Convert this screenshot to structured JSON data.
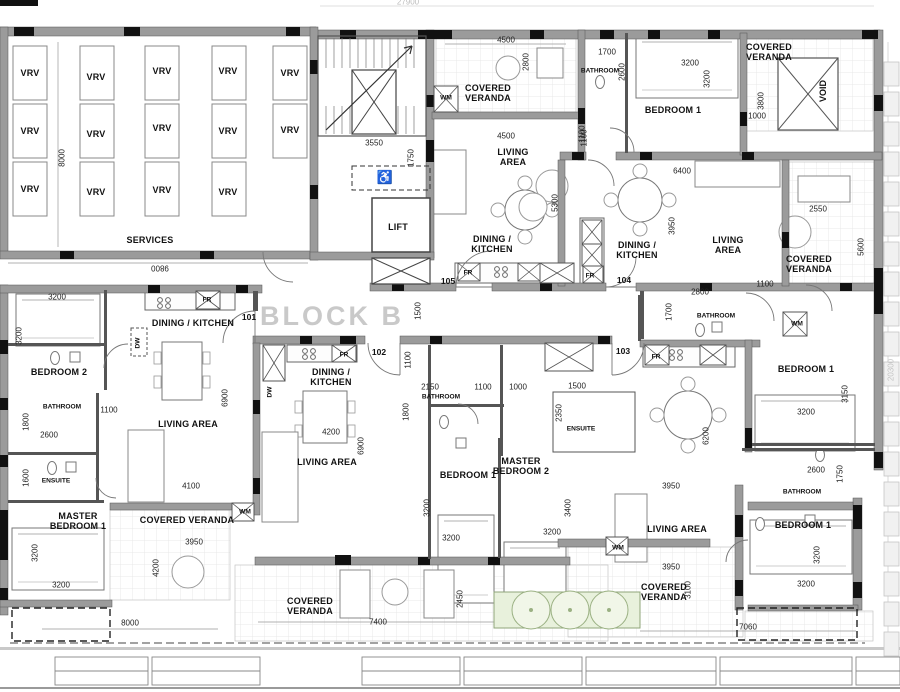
{
  "drawing": {
    "block_title": "BLOCK B",
    "overall_dims": {
      "top": "27900",
      "right": "20300"
    }
  },
  "annotations": [
    {
      "n": "vrv-label",
      "t": "VRV",
      "x": 30,
      "y": 73,
      "c": "room"
    },
    {
      "n": "vrv-label",
      "t": "VRV",
      "x": 30,
      "y": 131,
      "c": "room"
    },
    {
      "n": "vrv-label",
      "t": "VRV",
      "x": 30,
      "y": 189,
      "c": "room"
    },
    {
      "n": "vrv-label",
      "t": "VRV",
      "x": 96,
      "y": 77,
      "c": "room"
    },
    {
      "n": "vrv-label",
      "t": "VRV",
      "x": 96,
      "y": 134,
      "c": "room"
    },
    {
      "n": "vrv-label",
      "t": "VRV",
      "x": 96,
      "y": 192,
      "c": "room"
    },
    {
      "n": "vrv-label",
      "t": "VRV",
      "x": 162,
      "y": 71,
      "c": "room"
    },
    {
      "n": "vrv-label",
      "t": "VRV",
      "x": 162,
      "y": 128,
      "c": "room"
    },
    {
      "n": "vrv-label",
      "t": "VRV",
      "x": 162,
      "y": 190,
      "c": "room"
    },
    {
      "n": "vrv-label",
      "t": "VRV",
      "x": 228,
      "y": 71,
      "c": "room"
    },
    {
      "n": "vrv-label",
      "t": "VRV",
      "x": 228,
      "y": 131,
      "c": "room"
    },
    {
      "n": "vrv-label",
      "t": "VRV",
      "x": 228,
      "y": 192,
      "c": "room"
    },
    {
      "n": "vrv-label",
      "t": "VRV",
      "x": 290,
      "y": 73,
      "c": "room"
    },
    {
      "n": "vrv-label",
      "t": "VRV",
      "x": 290,
      "y": 130,
      "c": "room"
    },
    {
      "n": "room-label-services",
      "t": "SERVICES",
      "x": 150,
      "y": 240,
      "c": "room"
    },
    {
      "n": "dim-services-width",
      "t": "9800",
      "x": 160,
      "y": 267,
      "c": "dim180"
    },
    {
      "n": "dim-services-height",
      "t": "8000",
      "x": 63,
      "y": 158,
      "c": "dimv"
    },
    {
      "n": "dim-overall-top",
      "t": "27900",
      "x": 408,
      "y": 3,
      "c": "gray"
    },
    {
      "n": "dim-overall-right",
      "t": "20300",
      "x": 892,
      "y": 370,
      "c": "grayv"
    },
    {
      "n": "dim-stair-width",
      "t": "3550",
      "x": 374,
      "y": 144,
      "c": "dim"
    },
    {
      "n": "dim-stair-depth",
      "t": "1750",
      "x": 412,
      "y": 158,
      "c": "dimv"
    },
    {
      "n": "room-label-lift",
      "t": "LIFT",
      "x": 398,
      "y": 227,
      "c": "room"
    },
    {
      "n": "wheelchair-symbol",
      "t": "♿",
      "x": 385,
      "y": 178,
      "c": "sym"
    },
    {
      "n": "unit-number-105",
      "t": "105",
      "x": 448,
      "y": 282,
      "c": "num"
    },
    {
      "n": "wm-label-105",
      "t": "WM",
      "x": 446,
      "y": 98,
      "c": "rsmall"
    },
    {
      "n": "room-label-veranda-105",
      "t": "COVERED\nVERANDA",
      "x": 488,
      "y": 93,
      "c": "room"
    },
    {
      "n": "dim-veranda-105",
      "t": "4500",
      "x": 506,
      "y": 41,
      "c": "dim"
    },
    {
      "n": "dim-veranda-105-depth",
      "t": "2800",
      "x": 527,
      "y": 62,
      "c": "dimv"
    },
    {
      "n": "dim-living-105",
      "t": "4500",
      "x": 506,
      "y": 137,
      "c": "dim"
    },
    {
      "n": "dim-105-1100",
      "t": "1100",
      "x": 583,
      "y": 134,
      "c": "dimv"
    },
    {
      "n": "room-label-living-105",
      "t": "LIVING\nAREA",
      "x": 513,
      "y": 157,
      "c": "room"
    },
    {
      "n": "dim-living-105-depth",
      "t": "5300",
      "x": 556,
      "y": 203,
      "c": "dimv"
    },
    {
      "n": "room-label-dining-105",
      "t": "DINING /\nKITCHEN",
      "x": 492,
      "y": 244,
      "c": "room"
    },
    {
      "n": "fr-label-105",
      "t": "FR",
      "x": 468,
      "y": 273,
      "c": "rsmall"
    },
    {
      "n": "dim-corridor",
      "t": "1500",
      "x": 419,
      "y": 311,
      "c": "dimv"
    },
    {
      "n": "dim-corridor-entry",
      "t": "1100",
      "x": 409,
      "y": 360,
      "c": "dimv"
    },
    {
      "n": "block-title",
      "t": "BLOCK B",
      "x": 332,
      "y": 316,
      "c": "big"
    },
    {
      "n": "unit-number-101",
      "t": "101",
      "x": 249,
      "y": 318,
      "c": "num"
    },
    {
      "n": "room-label-dining-101",
      "t": "DINING / KITCHEN",
      "x": 193,
      "y": 323,
      "c": "room"
    },
    {
      "n": "fr-label-101",
      "t": "FR",
      "x": 207,
      "y": 300,
      "c": "rsmall"
    },
    {
      "n": "dw-label-101",
      "t": "DW",
      "x": 138,
      "y": 343,
      "c": "rsmallv"
    },
    {
      "n": "dim-bedroom2-width",
      "t": "3200",
      "x": 57,
      "y": 298,
      "c": "dim"
    },
    {
      "n": "dim-bedroom2-height",
      "t": "3200",
      "x": 20,
      "y": 336,
      "c": "dimv"
    },
    {
      "n": "room-label-bedroom2-101",
      "t": "BEDROOM 2",
      "x": 59,
      "y": 372,
      "c": "room"
    },
    {
      "n": "room-label-bath-101",
      "t": "BATHROOM",
      "x": 62,
      "y": 407,
      "c": "rsmall"
    },
    {
      "n": "dim-bath-101",
      "t": "1800",
      "x": 27,
      "y": 422,
      "c": "dimv"
    },
    {
      "n": "dim-bath-101-w",
      "t": "2600",
      "x": 49,
      "y": 436,
      "c": "dim"
    },
    {
      "n": "dim-101-1100",
      "t": "1100",
      "x": 109,
      "y": 411,
      "c": "dim"
    },
    {
      "n": "room-label-living-101",
      "t": "LIVING AREA",
      "x": 188,
      "y": 424,
      "c": "room"
    },
    {
      "n": "dim-living-101-depth",
      "t": "6900",
      "x": 226,
      "y": 398,
      "c": "dimv"
    },
    {
      "n": "room-label-ensuite-101",
      "t": "ENSUITE",
      "x": 56,
      "y": 481,
      "c": "rsmall"
    },
    {
      "n": "dim-ensuite-101",
      "t": "1600",
      "x": 27,
      "y": 478,
      "c": "dimv"
    },
    {
      "n": "room-label-master1-101",
      "t": "MASTER\nBEDROOM 1",
      "x": 78,
      "y": 521,
      "c": "room"
    },
    {
      "n": "dim-master1-101-h",
      "t": "3200",
      "x": 36,
      "y": 553,
      "c": "dimv"
    },
    {
      "n": "dim-master1-101-w",
      "t": "3200",
      "x": 61,
      "y": 586,
      "c": "dim"
    },
    {
      "n": "dim-living-101-w",
      "t": "4100",
      "x": 191,
      "y": 487,
      "c": "dim"
    },
    {
      "n": "room-label-veranda-101",
      "t": "COVERED VERANDA",
      "x": 187,
      "y": 520,
      "c": "room"
    },
    {
      "n": "wm-label-101",
      "t": "WM",
      "x": 245,
      "y": 512,
      "c": "rsmall"
    },
    {
      "n": "dim-veranda-101",
      "t": "3950",
      "x": 194,
      "y": 543,
      "c": "dim"
    },
    {
      "n": "dim-veranda-101-h",
      "t": "4200",
      "x": 157,
      "y": 568,
      "c": "dimv"
    },
    {
      "n": "dim-bottom-left",
      "t": "8000",
      "x": 130,
      "y": 624,
      "c": "dim"
    },
    {
      "n": "unit-number-102",
      "t": "102",
      "x": 379,
      "y": 353,
      "c": "num"
    },
    {
      "n": "room-label-dining-102",
      "t": "DINING /\nKITCHEN",
      "x": 331,
      "y": 377,
      "c": "room"
    },
    {
      "n": "fr-label-102",
      "t": "FR",
      "x": 344,
      "y": 355,
      "c": "rsmall"
    },
    {
      "n": "dw-label-102",
      "t": "DW",
      "x": 270,
      "y": 392,
      "c": "rsmallv"
    },
    {
      "n": "dim-dining-102",
      "t": "4200",
      "x": 331,
      "y": 433,
      "c": "dim"
    },
    {
      "n": "room-label-living-102",
      "t": "LIVING AREA",
      "x": 327,
      "y": 462,
      "c": "room"
    },
    {
      "n": "dim-living-102-depth",
      "t": "6900",
      "x": 362,
      "y": 446,
      "c": "dimv"
    },
    {
      "n": "dim-bath-102-w",
      "t": "2150",
      "x": 430,
      "y": 388,
      "c": "dim"
    },
    {
      "n": "dim-102-1100",
      "t": "1100",
      "x": 483,
      "y": 388,
      "c": "dim"
    },
    {
      "n": "dim-102-1000",
      "t": "1000",
      "x": 518,
      "y": 388,
      "c": "dim"
    },
    {
      "n": "dim-102-1500",
      "t": "1500",
      "x": 577,
      "y": 387,
      "c": "dim"
    },
    {
      "n": "room-label-bath-102",
      "t": "BATHROOM",
      "x": 441,
      "y": 397,
      "c": "rsmall"
    },
    {
      "n": "dim-bath-102-h",
      "t": "1800",
      "x": 407,
      "y": 412,
      "c": "dimv"
    },
    {
      "n": "room-label-bedroom1-102",
      "t": "BEDROOM 1",
      "x": 468,
      "y": 475,
      "c": "room"
    },
    {
      "n": "dim-bedroom1-102-h",
      "t": "3200",
      "x": 428,
      "y": 508,
      "c": "dimv"
    },
    {
      "n": "dim-bedroom1-102-w",
      "t": "3200",
      "x": 451,
      "y": 539,
      "c": "dim"
    },
    {
      "n": "room-label-master2-102",
      "t": "MASTER\nBEDROOM 2",
      "x": 521,
      "y": 466,
      "c": "room"
    },
    {
      "n": "dim-master2-102",
      "t": "2350",
      "x": 560,
      "y": 413,
      "c": "dimv"
    },
    {
      "n": "room-label-ensuite-102",
      "t": "ENSUITE",
      "x": 581,
      "y": 429,
      "c": "rsmall"
    },
    {
      "n": "dim-master2-102-h",
      "t": "3400",
      "x": 569,
      "y": 508,
      "c": "dimv"
    },
    {
      "n": "dim-master2-102-w",
      "t": "3200",
      "x": 552,
      "y": 533,
      "c": "dim"
    },
    {
      "n": "room-label-veranda-bottom",
      "t": "COVERED\nVERANDA",
      "x": 310,
      "y": 606,
      "c": "room"
    },
    {
      "n": "dim-veranda-bottom",
      "t": "7400",
      "x": 378,
      "y": 623,
      "c": "dim"
    },
    {
      "n": "dim-veranda-bottom-h",
      "t": "2450",
      "x": 461,
      "y": 599,
      "c": "dimv"
    },
    {
      "n": "unit-number-103",
      "t": "103",
      "x": 623,
      "y": 352,
      "c": "num"
    },
    {
      "n": "fr-label-103",
      "t": "FR",
      "x": 656,
      "y": 357,
      "c": "rsmall"
    },
    {
      "n": "room-label-bath-103",
      "t": "BATHROOM",
      "x": 716,
      "y": 316,
      "c": "rsmall"
    },
    {
      "n": "dim-bath-103-w",
      "t": "2800",
      "x": 700,
      "y": 293,
      "c": "dim"
    },
    {
      "n": "dim-bath-103-h",
      "t": "1700",
      "x": 670,
      "y": 312,
      "c": "dimv"
    },
    {
      "n": "dim-103-1100",
      "t": "1100",
      "x": 765,
      "y": 285,
      "c": "dim"
    },
    {
      "n": "wm-label-103-top",
      "t": "WM",
      "x": 797,
      "y": 324,
      "c": "rsmall"
    },
    {
      "n": "room-label-bedroom1-103",
      "t": "BEDROOM 1",
      "x": 806,
      "y": 369,
      "c": "room"
    },
    {
      "n": "dim-bedroom1-103-h",
      "t": "3150",
      "x": 846,
      "y": 394,
      "c": "dimv"
    },
    {
      "n": "dim-bedroom1-103-w",
      "t": "3200",
      "x": 806,
      "y": 413,
      "c": "dim"
    },
    {
      "n": "dim-living-103-depth",
      "t": "6200",
      "x": 707,
      "y": 436,
      "c": "dimv"
    },
    {
      "n": "dim-living-103-w",
      "t": "3950",
      "x": 671,
      "y": 487,
      "c": "dim"
    },
    {
      "n": "room-label-living-103",
      "t": "LIVING AREA",
      "x": 677,
      "y": 529,
      "c": "room"
    },
    {
      "n": "wm-label-103-btm",
      "t": "WM",
      "x": 618,
      "y": 548,
      "c": "rsmall"
    },
    {
      "n": "room-label-veranda-103",
      "t": "COVERED\nVERANDA",
      "x": 664,
      "y": 592,
      "c": "room"
    },
    {
      "n": "dim-veranda-103",
      "t": "3950",
      "x": 671,
      "y": 568,
      "c": "dim"
    },
    {
      "n": "dim-veranda-103-h",
      "t": "3100",
      "x": 689,
      "y": 590,
      "c": "dimv"
    },
    {
      "n": "room-label-bath2-103",
      "t": "BATHROOM",
      "x": 802,
      "y": 492,
      "c": "rsmall"
    },
    {
      "n": "dim-bath2-103-w",
      "t": "2600",
      "x": 816,
      "y": 471,
      "c": "dim"
    },
    {
      "n": "dim-bath2-103-h",
      "t": "1750",
      "x": 841,
      "y": 474,
      "c": "dimv"
    },
    {
      "n": "room-label-bedroom1b-103",
      "t": "BEDROOM 1",
      "x": 803,
      "y": 525,
      "c": "room"
    },
    {
      "n": "dim-bedroom1b-103-h",
      "t": "3200",
      "x": 818,
      "y": 555,
      "c": "dimv"
    },
    {
      "n": "dim-bedroom1b-103-w",
      "t": "3200",
      "x": 806,
      "y": 585,
      "c": "dim"
    },
    {
      "n": "dim-bottom-right",
      "t": "7060",
      "x": 748,
      "y": 628,
      "c": "dim"
    },
    {
      "n": "unit-number-104",
      "t": "104",
      "x": 624,
      "y": 281,
      "c": "num"
    },
    {
      "n": "room-label-bath-104",
      "t": "BATHROOM",
      "x": 600,
      "y": 71,
      "c": "rsmall"
    },
    {
      "n": "dim-bath-104-w",
      "t": "1700",
      "x": 607,
      "y": 53,
      "c": "dim"
    },
    {
      "n": "dim-bath-104-h",
      "t": "2600",
      "x": 623,
      "y": 72,
      "c": "dimv"
    },
    {
      "n": "room-label-bedroom1-104",
      "t": "BEDROOM 1",
      "x": 673,
      "y": 110,
      "c": "room"
    },
    {
      "n": "dim-bedroom1-104-w",
      "t": "3200",
      "x": 690,
      "y": 64,
      "c": "dim"
    },
    {
      "n": "dim-bedroom1-104-h",
      "t": "3200",
      "x": 708,
      "y": 79,
      "c": "dimv"
    },
    {
      "n": "room-label-veranda-104",
      "t": "COVERED\nVERANDA",
      "x": 769,
      "y": 52,
      "c": "room"
    },
    {
      "n": "dim-veranda-104-h",
      "t": "3800",
      "x": 762,
      "y": 101,
      "c": "dimv"
    },
    {
      "n": "dim-104-1000",
      "t": "1000",
      "x": 757,
      "y": 117,
      "c": "dim"
    },
    {
      "n": "room-label-void",
      "t": "VOID",
      "x": 823,
      "y": 91,
      "c": "roomv"
    },
    {
      "n": "dim-104-1100",
      "t": "1100",
      "x": 585,
      "y": 138,
      "c": "dimv"
    },
    {
      "n": "dim-104-6400",
      "t": "6400",
      "x": 682,
      "y": 172,
      "c": "dim"
    },
    {
      "n": "dim-104-3950",
      "t": "3950",
      "x": 673,
      "y": 226,
      "c": "dimv"
    },
    {
      "n": "room-label-dining-104",
      "t": "DINING /\nKITCHEN",
      "x": 637,
      "y": 250,
      "c": "room"
    },
    {
      "n": "room-label-living-104",
      "t": "LIVING\nAREA",
      "x": 728,
      "y": 245,
      "c": "room"
    },
    {
      "n": "fr-label-104",
      "t": "FR",
      "x": 590,
      "y": 276,
      "c": "rsmall"
    },
    {
      "n": "dim-veranda-right-w",
      "t": "2550",
      "x": 818,
      "y": 210,
      "c": "dim"
    },
    {
      "n": "dim-veranda-right-h",
      "t": "5600",
      "x": 862,
      "y": 247,
      "c": "dimv"
    },
    {
      "n": "room-label-veranda-right",
      "t": "COVERED\nVERANDA",
      "x": 809,
      "y": 264,
      "c": "room"
    }
  ]
}
